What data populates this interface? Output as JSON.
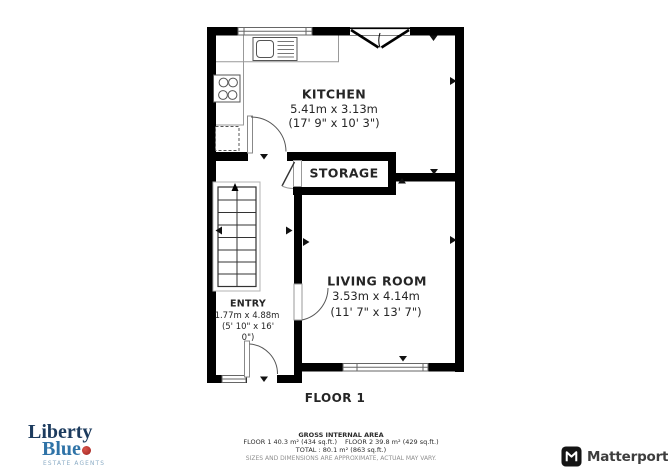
{
  "floor_plan": {
    "floor_label": "FLOOR 1",
    "rooms": [
      {
        "name": "KITCHEN",
        "dims_m": "5.41m x 3.13m",
        "dims_ft": "(17' 9\" x 10' 3\")"
      },
      {
        "name": "STORAGE"
      },
      {
        "name": "LIVING ROOM",
        "dims_m": "3.53m x 4.14m",
        "dims_ft": "(11' 7\" x 13' 7\")"
      },
      {
        "name": "ENTRY",
        "dims_m": "1.77m x 4.88m",
        "dims_ft_line1": "(5' 10\" x 16'",
        "dims_ft_line2": "0\")"
      }
    ],
    "icons": [
      "stairs-icon",
      "sink-icon",
      "hob-icon",
      "appliance-dashed-icon",
      "door-swing-icon",
      "window-icon"
    ]
  },
  "footer": {
    "gross_title": "GROSS INTERNAL AREA",
    "floor1_area": "FLOOR 1 40.3 m² (434 sq.ft.)",
    "floor2_area": "FLOOR 2 39.8 m² (429 sq.ft.)",
    "total_area": "TOTAL :  80.1 m² (863 sq.ft.)",
    "disclaimer": "SIZES AND DIMENSIONS ARE APPROXIMATE, ACTUAL MAY VARY."
  },
  "branding": {
    "liberty_blue": {
      "line1": "Liberty",
      "line2": "Blue",
      "tagline": "ESTATE AGENTS",
      "navy_color": "#1c3b5e",
      "blue_color": "#2f73a7",
      "red_dot_color": "#b02a22",
      "tagline_color": "#8aabc4"
    },
    "matterport": {
      "name": "Matterport",
      "text_color": "#3d3d3d",
      "icon_color": "#141414"
    }
  },
  "colors": {
    "walls": "#000000",
    "background": "#ffffff",
    "fixture_lines": "#999999"
  }
}
